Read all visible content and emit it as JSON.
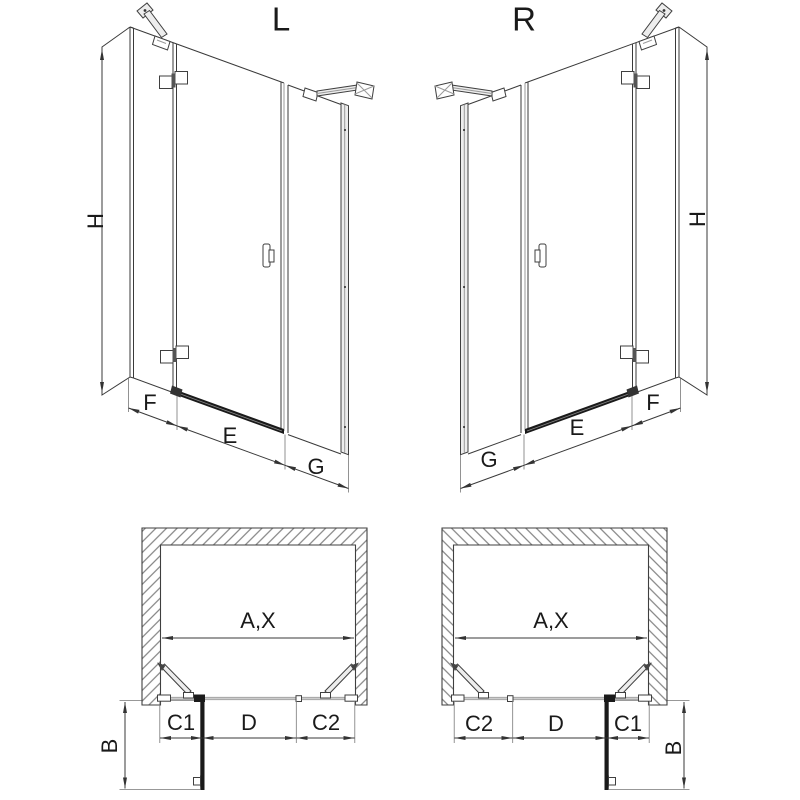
{
  "drawing": {
    "elevation_left": {
      "title": "L",
      "dim_height": "H",
      "dim_fixed_hinge_panel": "F",
      "dim_door": "E",
      "dim_fixed_far_panel": "G"
    },
    "elevation_right": {
      "title": "R",
      "dim_height": "H",
      "dim_fixed_hinge_panel": "F",
      "dim_door": "E",
      "dim_fixed_far_panel": "G"
    },
    "plan_left": {
      "dim_opening_width": "A,X",
      "dim_c1": "C1",
      "dim_d": "D",
      "dim_c2": "C2",
      "dim_door_projection": "B"
    },
    "plan_right": {
      "dim_opening_width": "A,X",
      "dim_c2": "C2",
      "dim_d": "D",
      "dim_c1": "C1",
      "dim_door_projection": "B"
    }
  },
  "colors": {
    "line": "#3a3a3a",
    "dark": "#1a1a1a",
    "light_line": "#9a9a9a",
    "hatch": "#777777",
    "background": "#ffffff"
  }
}
